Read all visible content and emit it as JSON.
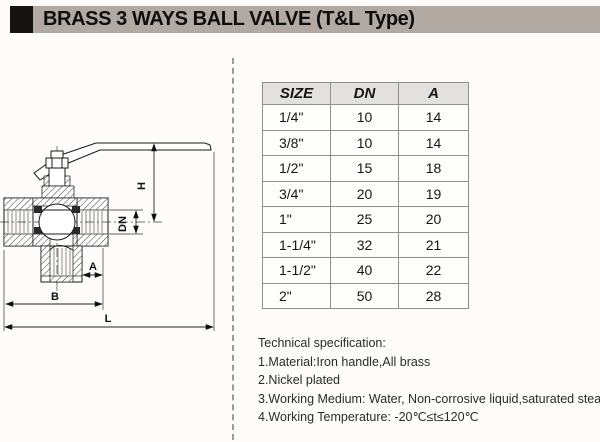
{
  "header": {
    "title": "BRASS 3 WAYS BALL VALVE (T&L Type)",
    "bar_color": "#b1a9a2",
    "accent_color": "#161311"
  },
  "drawing": {
    "labels": {
      "h": "H",
      "dn": "DN",
      "a": "A",
      "b": "B",
      "l": "L"
    }
  },
  "table": {
    "columns": [
      "SIZE",
      "DN",
      "A"
    ],
    "header_bg": "#e2e1df",
    "border_color": "#8f8f8f",
    "rows": [
      [
        "1/4\"",
        "10",
        "14"
      ],
      [
        "3/8\"",
        "10",
        "14"
      ],
      [
        "1/2\"",
        "15",
        "18"
      ],
      [
        "3/4\"",
        "20",
        "19"
      ],
      [
        "1\"",
        "25",
        "20"
      ],
      [
        "1-1/4\"",
        "32",
        "21"
      ],
      [
        "1-1/2\"",
        "40",
        "22"
      ],
      [
        "2\"",
        "50",
        "28"
      ]
    ]
  },
  "specs": {
    "title": "Technical specification:",
    "items": [
      "1.Material:Iron handle,All brass",
      "2.Nickel plated",
      "3.Working Medium: Water, Non-corrosive liquid,saturated steam",
      "4.Working Temperature: -20℃≤t≤120℃"
    ]
  }
}
